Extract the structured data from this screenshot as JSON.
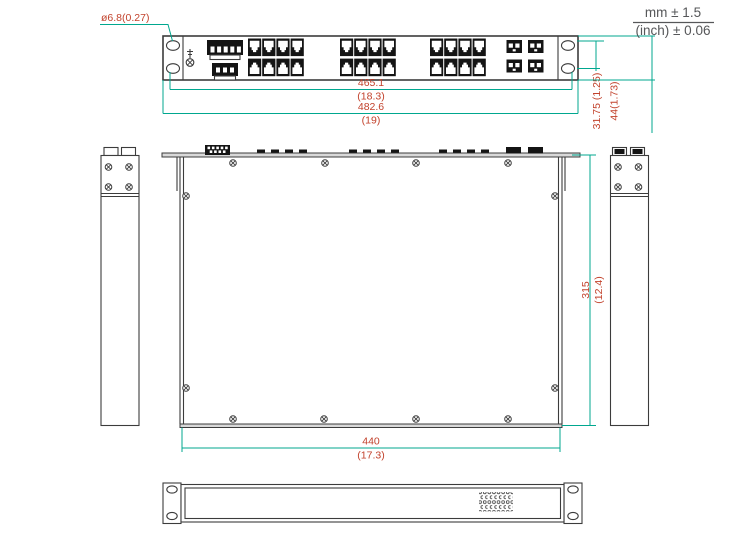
{
  "tolerance_note": {
    "metric": "mm ± 1.5",
    "imperial": "(inch) ± 0.06"
  },
  "dimensions": {
    "mount_hole_diameter": "ø6.8(0.27)",
    "rack_hole_spacing_mm": "465.1",
    "rack_hole_spacing_in": "(18.3)",
    "overall_width_mm": "482.6",
    "overall_width_in": "(19)",
    "ear_hole_pitch": "31.75 (1.25)",
    "overall_height": "44(1.73)",
    "depth_mm": "315",
    "depth_in": "(12.4)",
    "body_width_mm": "440",
    "body_width_in": "(17.3)"
  },
  "colors": {
    "dimension_line": "#00a78f",
    "dimension_text": "#c2422c",
    "drawing_line": "#3c3c3c",
    "note_text": "#565759",
    "port_fill": "#141414"
  },
  "icons": {
    "screw": "⊗",
    "ground": "⏚",
    "rj45_port": "▯",
    "fiber_port": "▣",
    "mount_hole": "◯"
  }
}
